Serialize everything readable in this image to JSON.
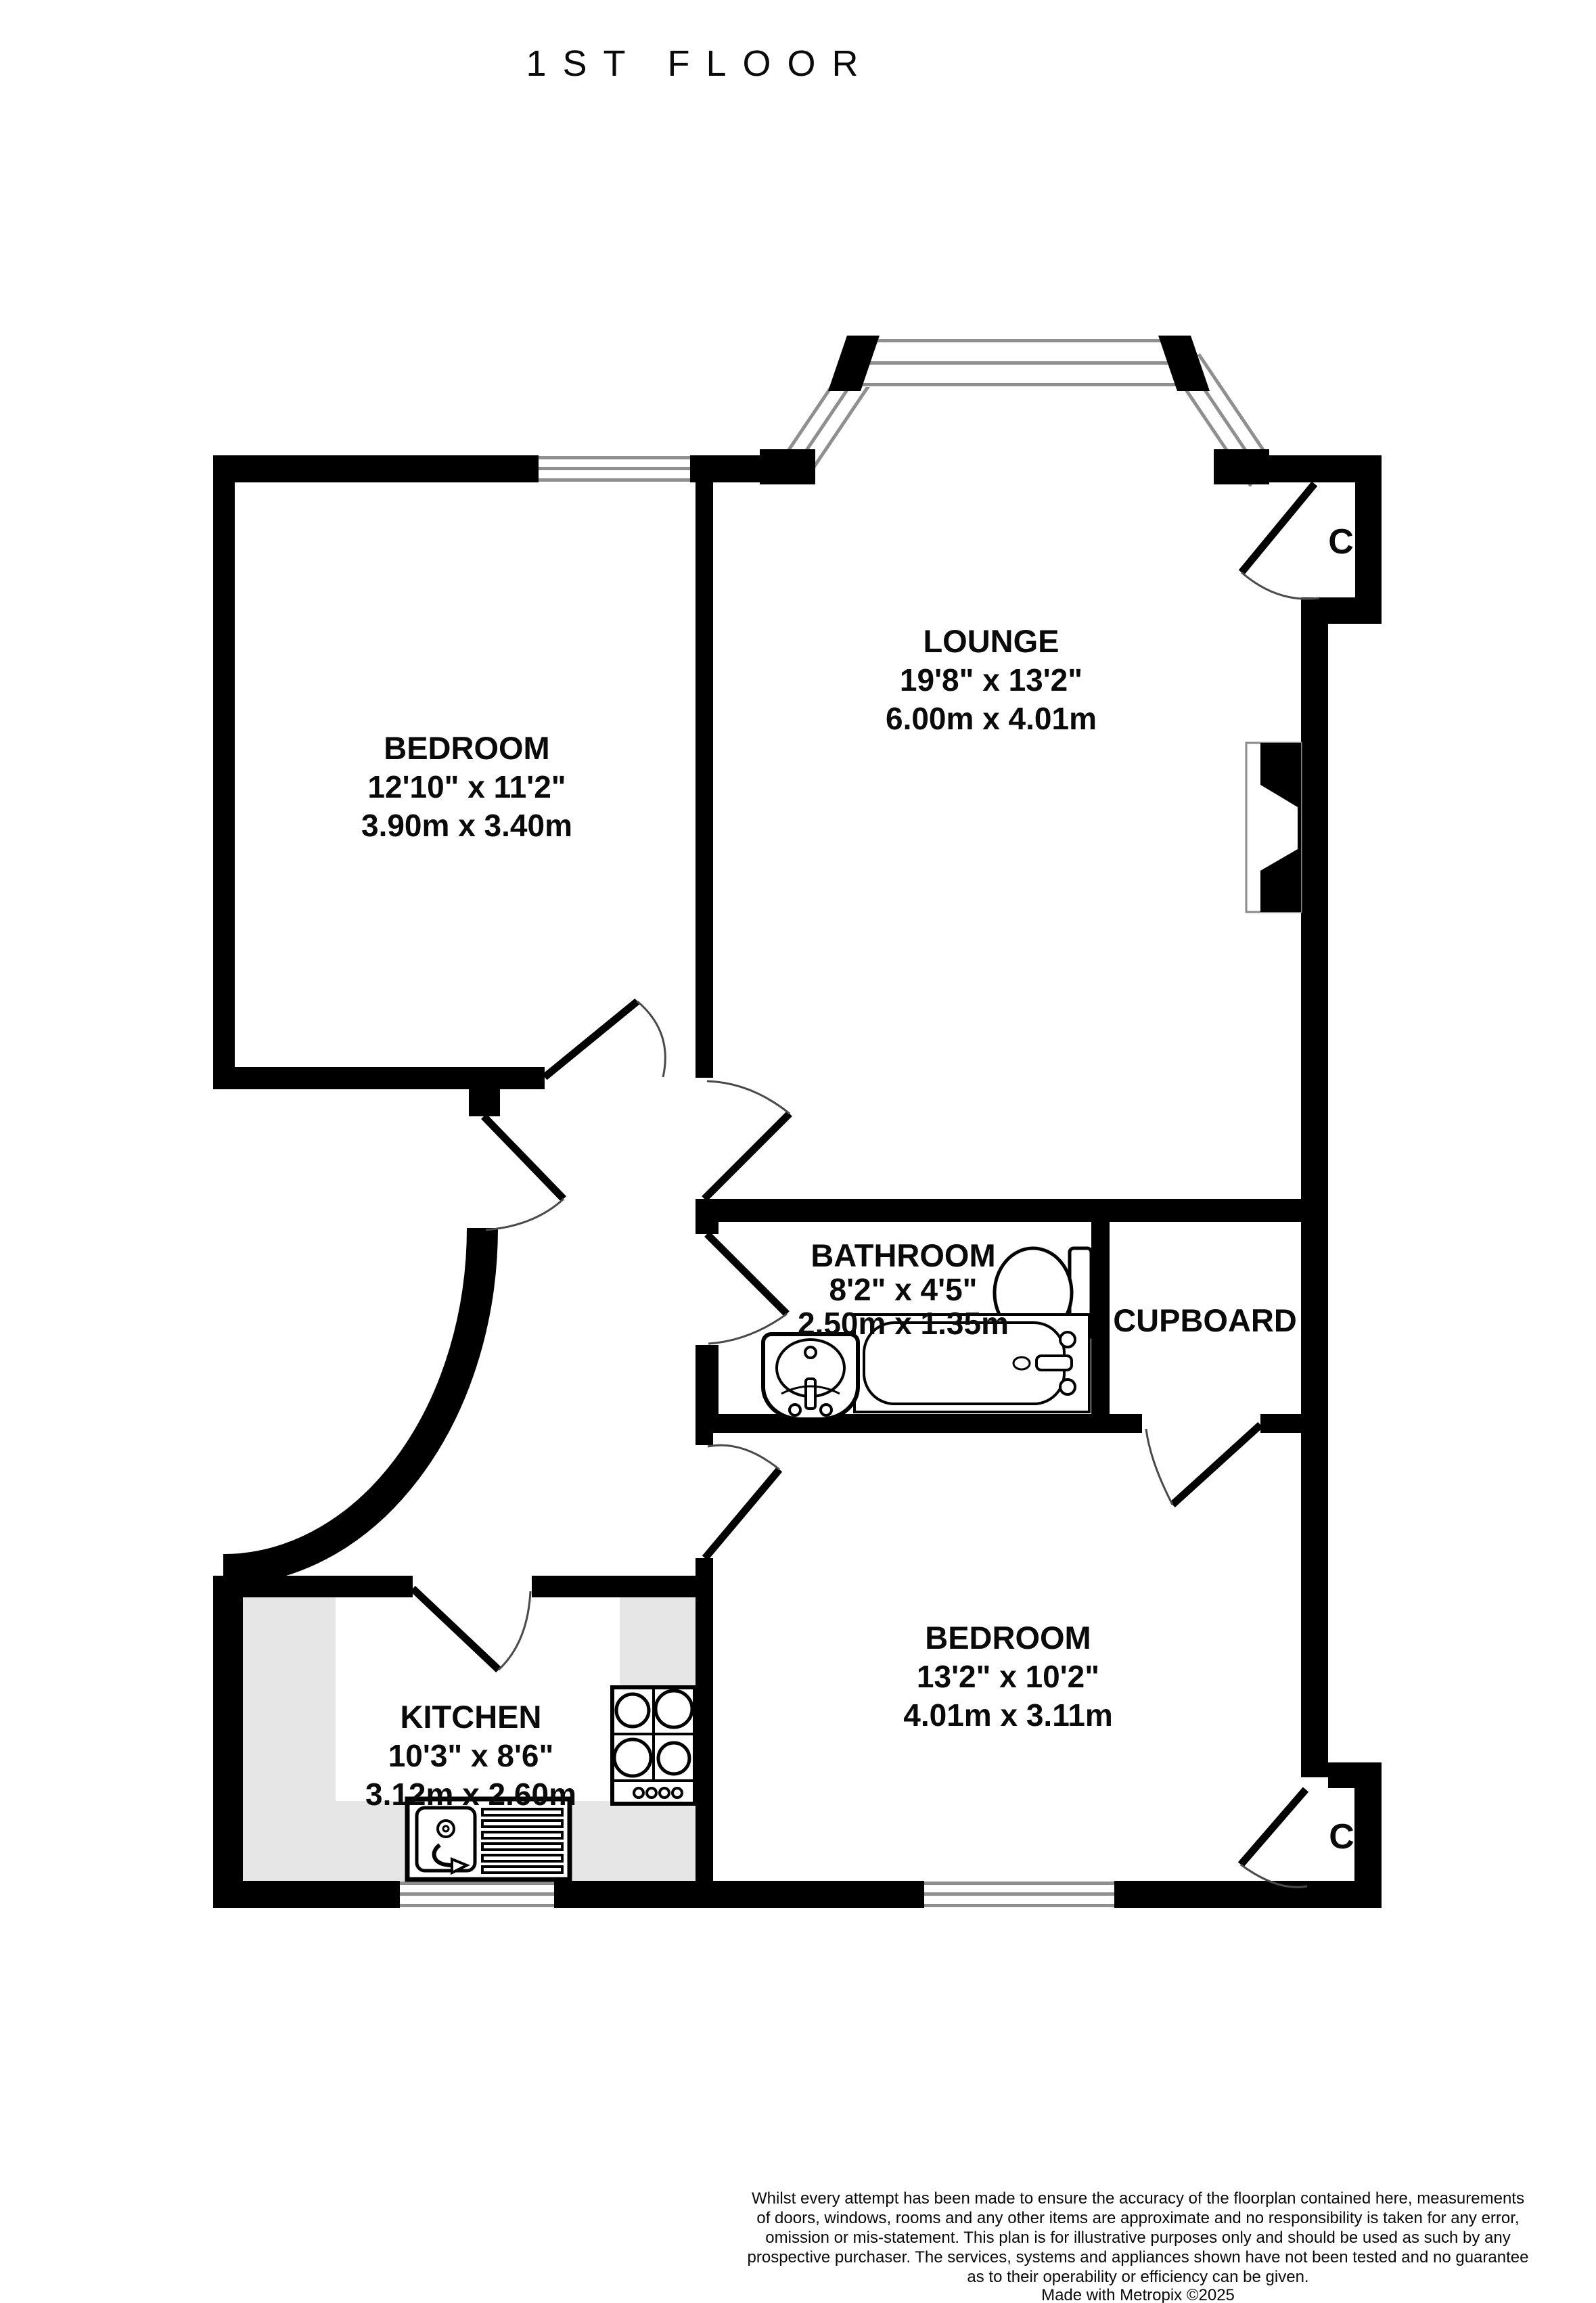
{
  "title": "1ST FLOOR",
  "rooms": {
    "bedroom1": {
      "name": "BEDROOM",
      "dims_imperial": "12'10\" x 11'2\"",
      "dims_metric": "3.90m x 3.40m"
    },
    "lounge": {
      "name": "LOUNGE",
      "dims_imperial": "19'8\" x 13'2\"",
      "dims_metric": "6.00m x 4.01m"
    },
    "bathroom": {
      "name": "BATHROOM",
      "dims_imperial": "8'2\" x 4'5\"",
      "dims_metric": "2.50m x 1.35m"
    },
    "cupboard": {
      "name": "CUPBOARD"
    },
    "bedroom2": {
      "name": "BEDROOM",
      "dims_imperial": "13'2\" x 10'2\"",
      "dims_metric": "4.01m x 3.11m"
    },
    "kitchen": {
      "name": "KITCHEN",
      "dims_imperial": "10'3\" x 8'6\"",
      "dims_metric": "3.12m x 2.60m"
    }
  },
  "closets": {
    "top": "C",
    "bottom": "C"
  },
  "footer": {
    "line1": "Whilst every attempt has been made to ensure the accuracy of the floorplan contained here, measurements",
    "line2": "of doors, windows, rooms and any other items are approximate and no responsibility is taken for any error,",
    "line3": "omission or mis-statement. This plan is for illustrative purposes only and should be used as such by any",
    "line4": "prospective purchaser. The services, systems and appliances shown have not been tested and no guarantee",
    "line5": "as to their operability or efficiency can be given.",
    "credit": "Made with Metropix ©2025"
  },
  "colors": {
    "wall": "#000000",
    "counter_gray": "#e6e6e6",
    "window_line": "#8f8f8f"
  }
}
